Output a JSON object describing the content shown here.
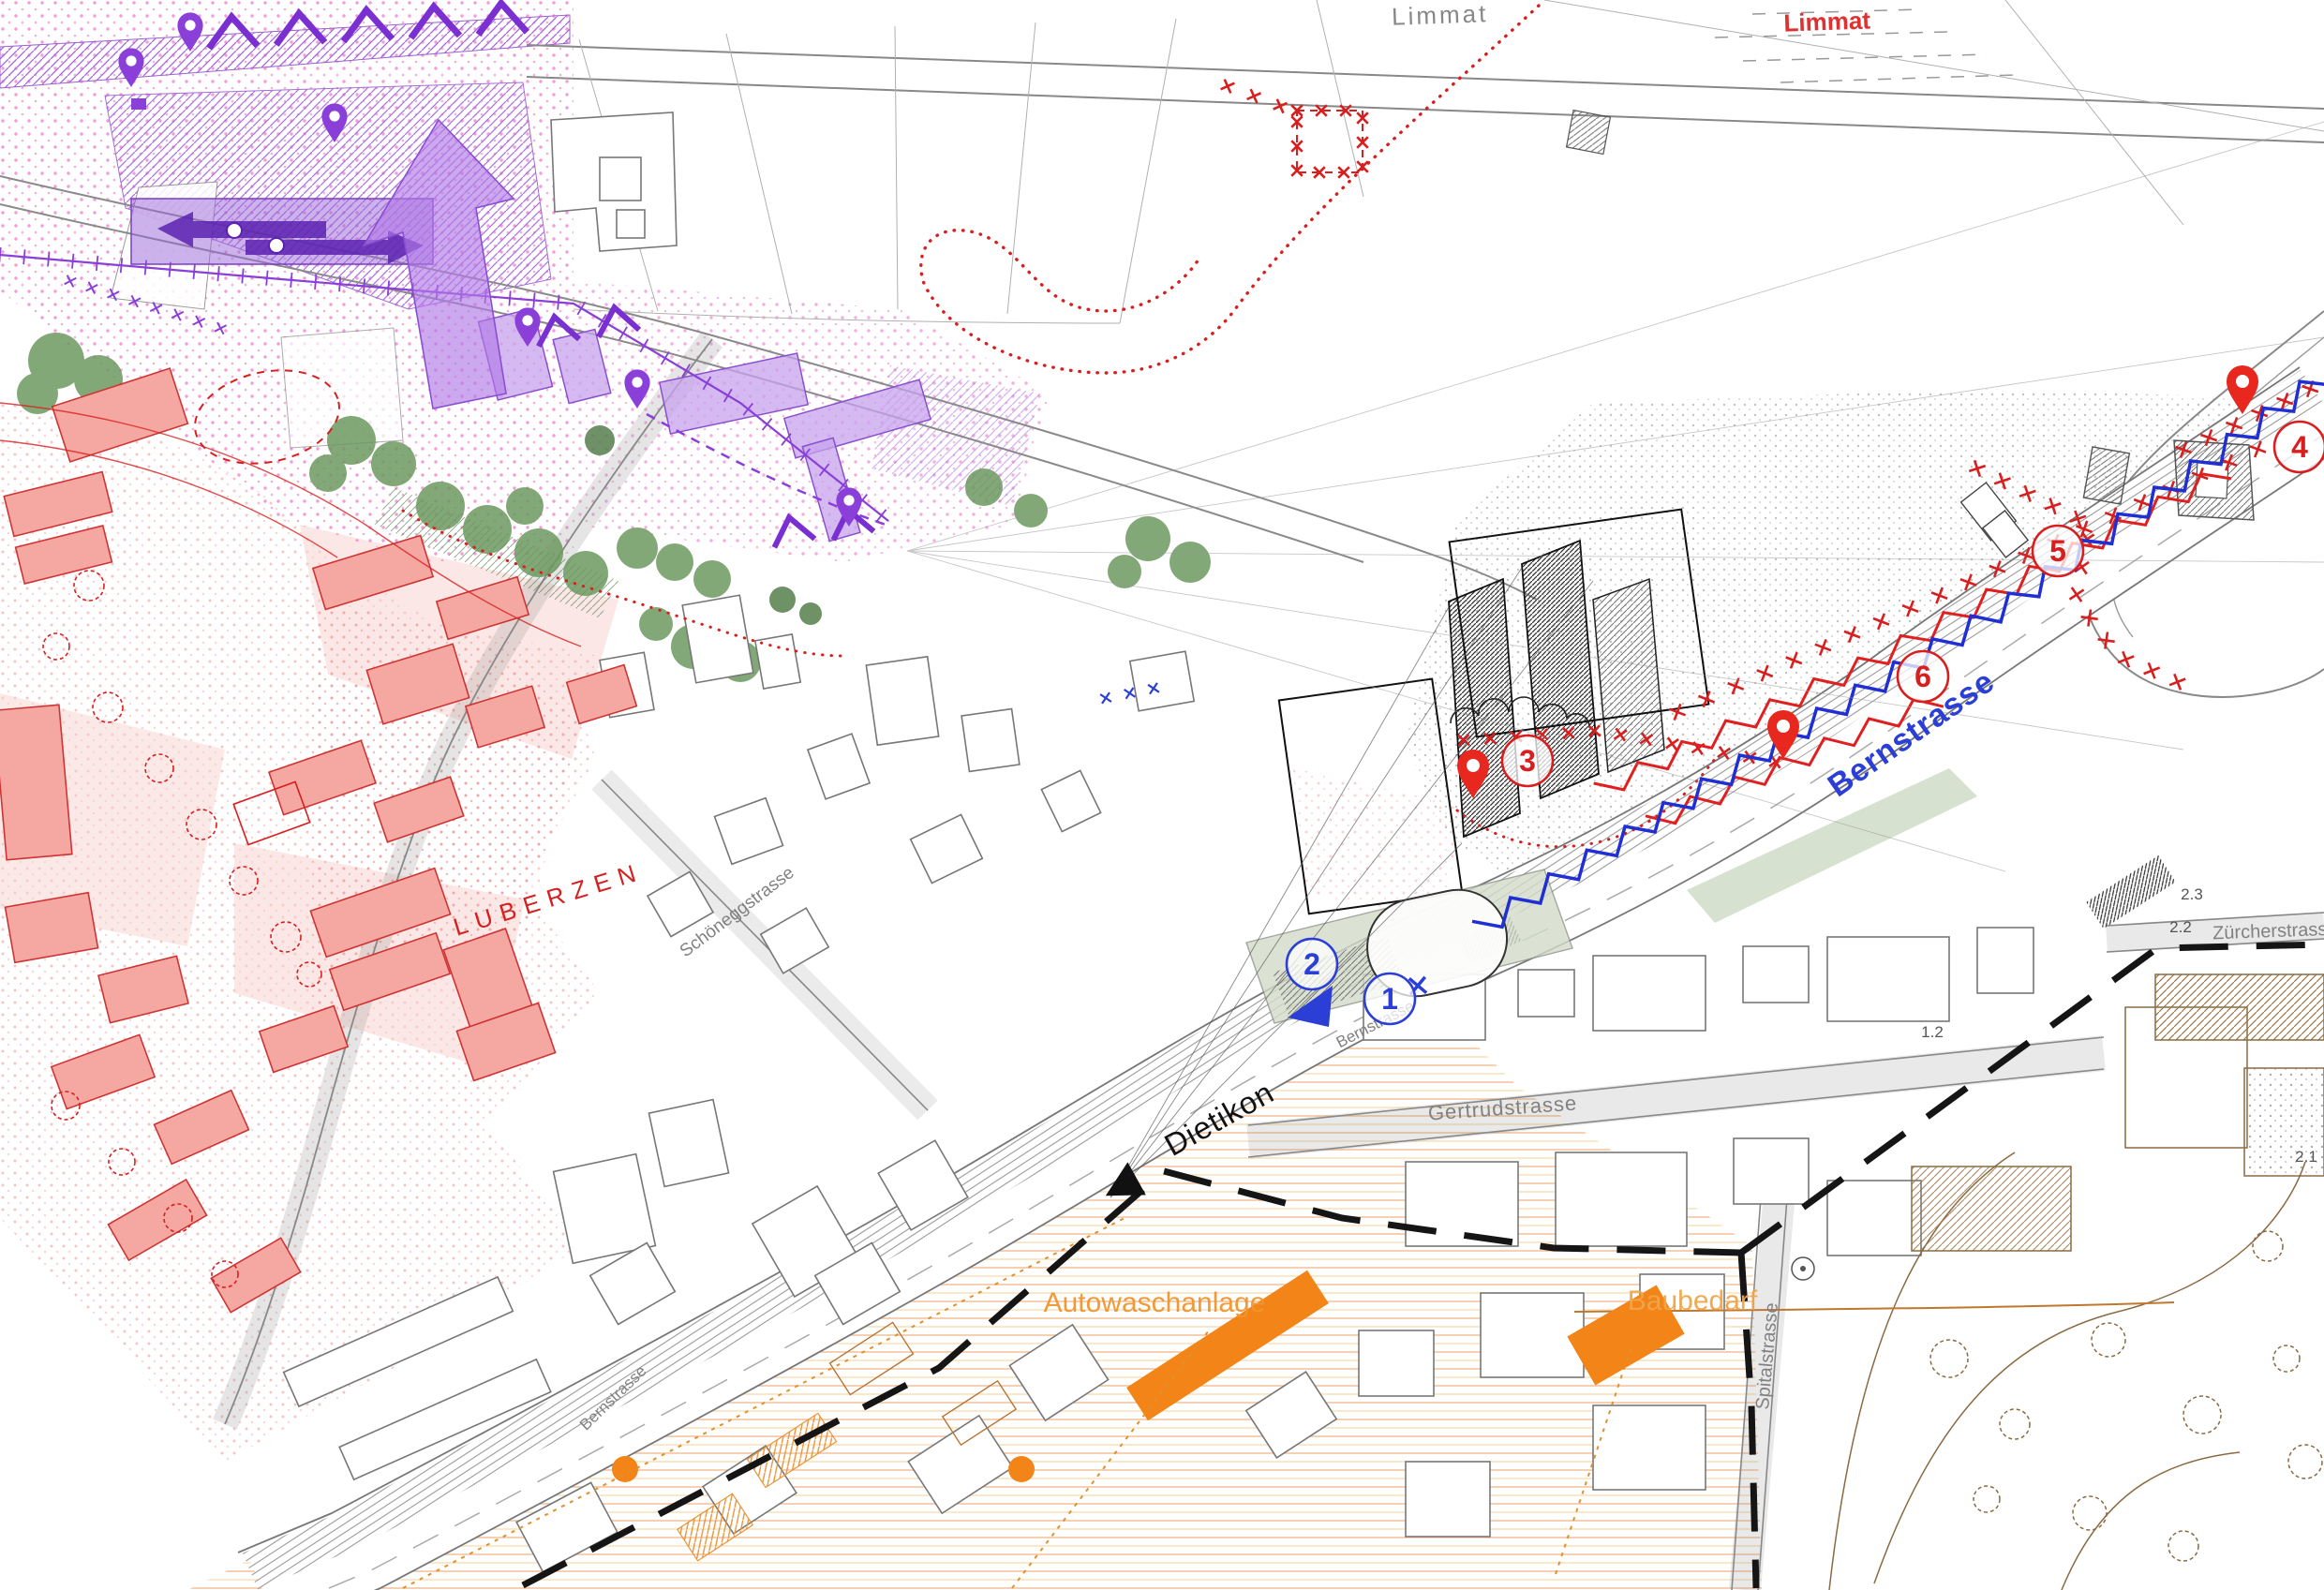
{
  "map": {
    "type": "urban-planning-masterplan",
    "labels": {
      "limmat_gray": "Limmat",
      "limmat_red": "Limmat",
      "bernstrasse_blue": "Bernstrasse",
      "bernstrasse_small_1": "Bernstrasse",
      "bernstrasse_small_2": "Bernstrasse",
      "luberzen": "LUBERZEN",
      "dietikon": "Dietikon",
      "autowaschanlage": "Autowaschanlage",
      "baubedarf": "Baubedarf",
      "gertrudstrasse": "Gertrudstrasse",
      "spitalstrasse": "Spitalstrasse",
      "zuercherstrasse": "Zürcherstrasse",
      "schoeneggstrasse": "Schöneggstrasse",
      "meas_22": "2.2",
      "meas_23": "2.3",
      "meas_12": "1.2",
      "meas_21": "2.1"
    },
    "markers": {
      "m1": {
        "label": "1",
        "color": "#2b3fd6"
      },
      "m2": {
        "label": "2",
        "color": "#2b3fd6"
      },
      "m3": {
        "label": "3",
        "color": "#d81f1f"
      },
      "m4": {
        "label": "4",
        "color": "#d81f1f"
      },
      "m5": {
        "label": "5",
        "color": "#d81f1f"
      },
      "m6": {
        "label": "6",
        "color": "#d81f1f"
      }
    },
    "icons": {
      "pin_red": "location-pin",
      "pin_purple": "location-pin",
      "direction_arrow": "direction-triangle",
      "chevron": "flow-chevron",
      "cross_chain": "barrier-cross",
      "zigzag_blue": "noise-barrier",
      "zigzag_red": "planned-barrier"
    },
    "colors": {
      "purple": "#8a3fd8",
      "violet_fill": "#c7a3ee",
      "pink_stipple": "#f06ac8",
      "red": "#d81f1f",
      "building_pink": "#f5a8a2",
      "green": "#6d9960",
      "blue": "#2b3fd6",
      "orange": "#f28418",
      "orange_label": "#f0952e",
      "brown": "#8a6a42",
      "gray_line": "#777777",
      "black": "#151515"
    }
  }
}
